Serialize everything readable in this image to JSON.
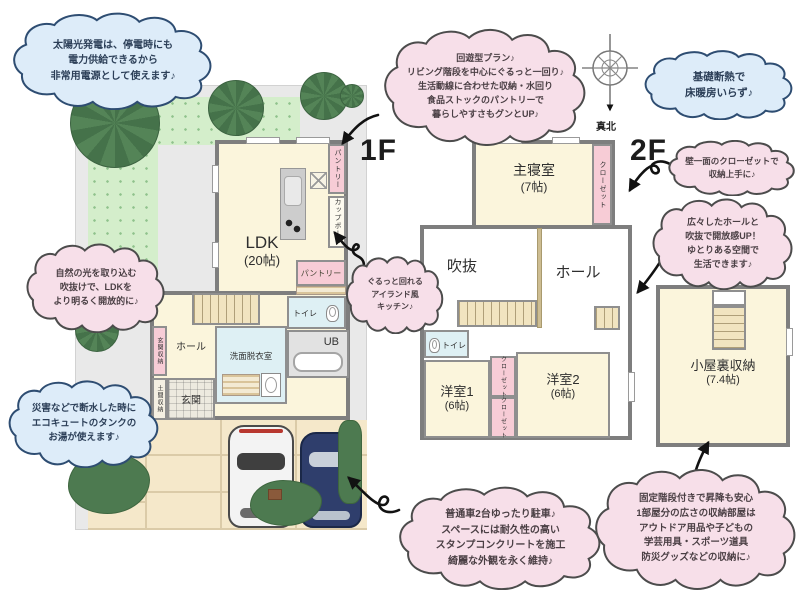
{
  "floors": {
    "f1_label": "1F",
    "f2_label": "2F"
  },
  "compass": {
    "label": "真北"
  },
  "bubbles": [
    {
      "id": "solar",
      "color": "blue",
      "lines": [
        "太陽光発電は、停電時にも",
        "電力供給できるから",
        "非常用電源として使えます♪"
      ]
    },
    {
      "id": "circulation",
      "color": "pink",
      "lines": [
        "回遊型プラン♪",
        "リビング階段を中心にぐるっと一回り♪",
        "生活動線に合わせた収納・水回り",
        "食品ストックのパントリーで",
        "暮らしやすさもグンとUP♪"
      ]
    },
    {
      "id": "insulation",
      "color": "blue",
      "lines": [
        "基礎断熱で",
        "床暖房いらず♪"
      ]
    },
    {
      "id": "closet_wall",
      "color": "pink",
      "lines": [
        "壁一面のクローゼットで",
        "収納上手に♪"
      ]
    },
    {
      "id": "hall_void",
      "color": "pink",
      "lines": [
        "広々したホールと",
        "吹抜で開放感UP！",
        "ゆとりある空間で",
        "生活できます♪"
      ]
    },
    {
      "id": "natural_light",
      "color": "pink",
      "lines": [
        "自然の光を取り込む",
        "吹抜けで、LDKを",
        "より明るく開放的に♪"
      ]
    },
    {
      "id": "ecocute",
      "color": "blue",
      "lines": [
        "災害などで断水した時に",
        "エコキュートのタンクの",
        "お湯が使えます♪"
      ]
    },
    {
      "id": "island_kitchen",
      "color": "pink",
      "lines": [
        "ぐるっと回れる",
        "アイランド風",
        "キッチン♪"
      ]
    },
    {
      "id": "parking",
      "color": "pink",
      "lines": [
        "普通車2台ゆったり駐車♪",
        "スペースには耐久性の高い",
        "スタンプコンクリートを施工",
        "綺麗な外観を永く維持♪"
      ]
    },
    {
      "id": "attic",
      "color": "pink",
      "lines": [
        "固定階段付きで昇降も安心",
        "1部屋分の広さの収納部屋は",
        "アウトドア用品や子どもの",
        "学芸用具・スポーツ道具",
        "防災グッズなどの収納に♪"
      ]
    }
  ],
  "floor1": {
    "ldk": "LDK",
    "ldk_size": "(20帖)",
    "pantry_strip": "パントリー",
    "cupboard": "カップボード",
    "pantry_room": "パントリー",
    "toilet": "トイレ",
    "bath": "UB",
    "washroom": "洗面脱衣室",
    "hall": "ホール",
    "entrance": "玄関",
    "entrance_storage": "玄関収納",
    "doma_storage": "土間収納"
  },
  "floor2": {
    "master": "主寝室",
    "master_size": "(7帖)",
    "closet": "クローゼット",
    "void": "吹抜",
    "hall": "ホール",
    "toilet": "トイレ",
    "room1": "洋室1",
    "room1_size": "(6帖)",
    "room2": "洋室2",
    "room2_size": "(6帖)",
    "closet1": "クローゼット",
    "closet2": "クローゼット",
    "attic": "小屋裏収納",
    "attic_size": "(7.4帖)"
  },
  "colors": {
    "pink_bubble": "#f7dfe9",
    "blue_bubble": "#ddecf9",
    "room_cream": "#fbf5dc",
    "closet_pink": "#f7ccd6",
    "wet_blue": "#def0f4",
    "lawn_green": "#d4eecb",
    "wall_gray": "#7e7e7e"
  }
}
